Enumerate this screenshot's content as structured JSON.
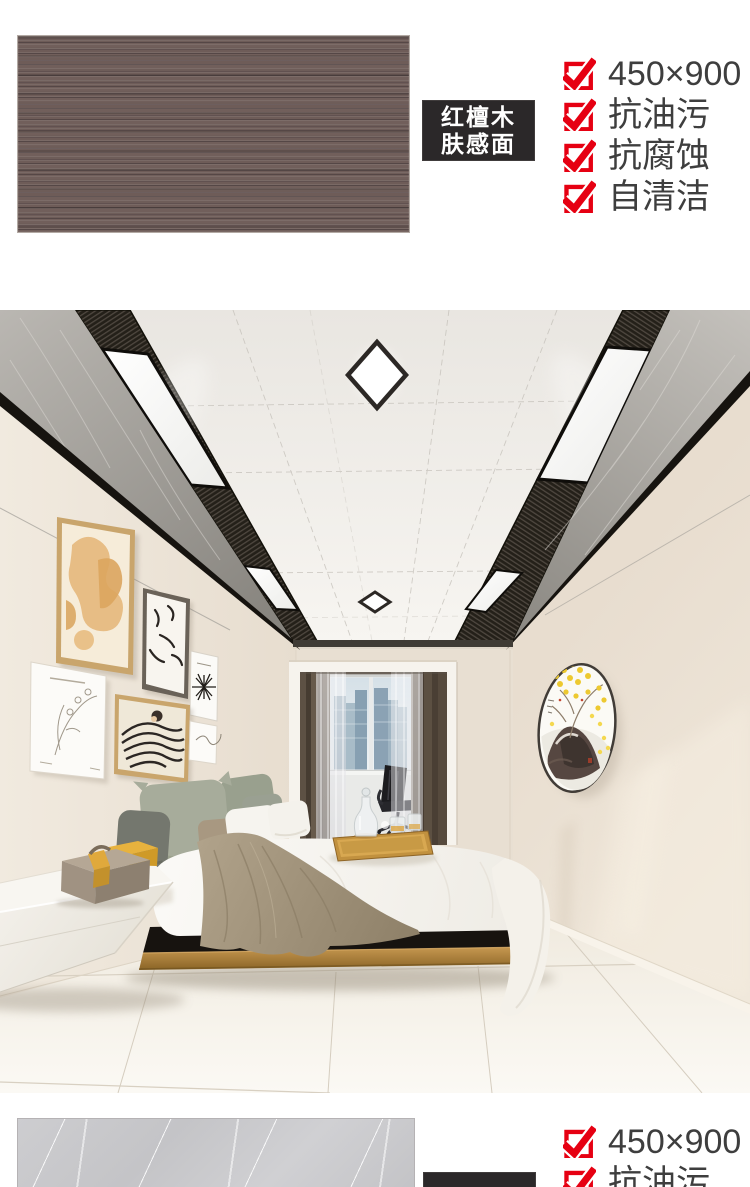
{
  "sections": {
    "top": {
      "label": {
        "line1": "红檀木",
        "line2": "肤感面"
      },
      "features": [
        "450×900",
        "抗油污",
        "抗腐蚀",
        "自清洁"
      ]
    },
    "bottom": {
      "features": [
        "450×900",
        "抗油污"
      ]
    }
  },
  "colors": {
    "accent_red": "#e60012",
    "feature_text": "#3e3e3e",
    "label_bg": "#2b2829",
    "label_text": "#ffffff",
    "wood_swatch": "#6a5955",
    "marble_swatch": "#c9c9cb"
  },
  "scene": {
    "type": "bedroom-interior-rendering",
    "elements": [
      "ceiling-panels",
      "led-strip-lights",
      "diamond-ceiling-lights",
      "marble-ceiling-border",
      "gallery-wall-frames",
      "window-with-city-view",
      "curtains",
      "office-chair",
      "desk",
      "round-fan-artwork",
      "platform-bed",
      "pillows",
      "throw-blanket",
      "wooden-serving-tray",
      "floating-nightstand",
      "storage-boxes",
      "tile-floor"
    ]
  }
}
